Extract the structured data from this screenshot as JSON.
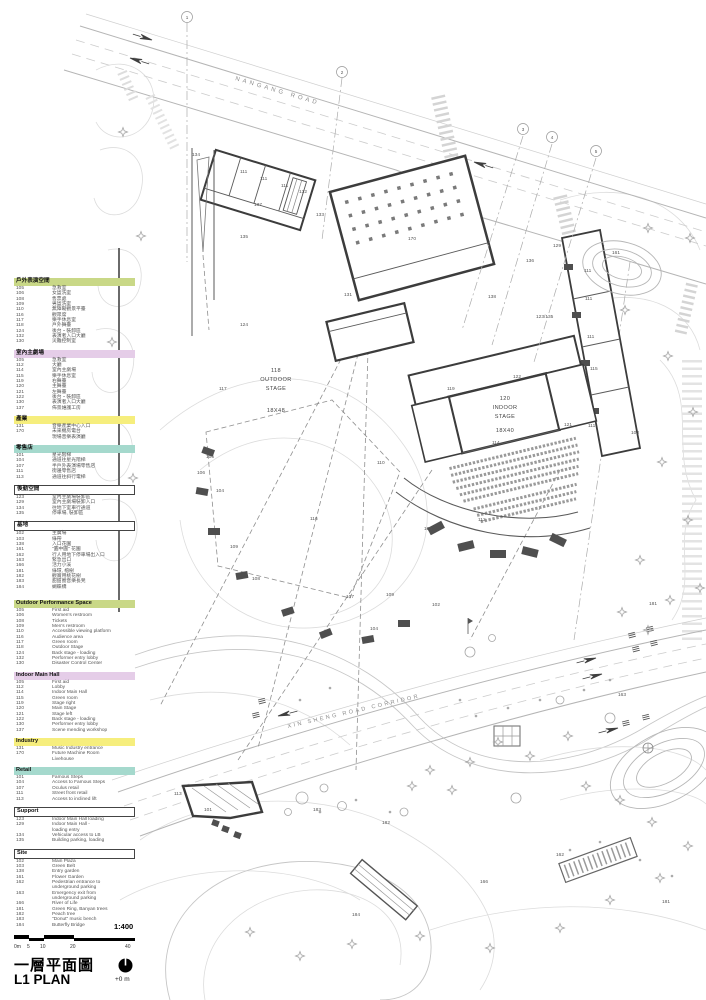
{
  "colors": {
    "outdoor": "#c9d887",
    "indoor": "#e5cde8",
    "industry": "#f6ee7d",
    "retail": "#a5d9cd",
    "plain": "#ffffff"
  },
  "roads": {
    "north_label": "NANGANG ROAD",
    "south_label": "XIN SHENG ROAD CORRIDOR"
  },
  "grid_bubbles": [
    "1",
    "2",
    "3",
    "4",
    "5"
  ],
  "stages": {
    "outdoor": {
      "code": "118",
      "line1": "OUTDOOR",
      "line2": "STAGE",
      "dim": "18X48"
    },
    "indoor": {
      "code": "120",
      "line1": "INDOOR",
      "line2": "STAGE",
      "dim": "18X40"
    }
  },
  "legend_zh": [
    {
      "header": "戶外表演空間",
      "color": "outdoor",
      "items": [
        [
          "105",
          "急救室"
        ],
        [
          "106",
          "女盥洗室"
        ],
        [
          "108",
          "售票處"
        ],
        [
          "109",
          "男盥洗室"
        ],
        [
          "110",
          "無障礙觀景平臺"
        ],
        [
          "116",
          "觀眾席"
        ],
        [
          "117",
          "樂手休息室"
        ],
        [
          "118",
          "戶外舞臺"
        ],
        [
          "124",
          "後台・裝卸區"
        ],
        [
          "132",
          "表演者入口大廳"
        ],
        [
          "130",
          "災難控制室"
        ]
      ]
    },
    {
      "header": "室內主劇場",
      "color": "indoor",
      "items": [
        [
          "105",
          "急救室"
        ],
        [
          "112",
          "大廳"
        ],
        [
          "114",
          "室內主劇場"
        ],
        [
          "115",
          "樂手休息室"
        ],
        [
          "119",
          "右舞臺"
        ],
        [
          "120",
          "主舞臺"
        ],
        [
          "121",
          "左舞臺"
        ],
        [
          "122",
          "後台・裝卸區"
        ],
        [
          "130",
          "表演者入口大廳"
        ],
        [
          "137",
          "佈景維護工房"
        ]
      ]
    },
    {
      "header": "產業",
      "color": "industry",
      "items": [
        [
          "131",
          "音樂產業中心入口"
        ],
        [
          "170",
          "未來機房電台\n現場音樂表演廳"
        ]
      ]
    },
    {
      "header": "零售店",
      "color": "retail",
      "items": [
        [
          "101",
          "星光階梯"
        ],
        [
          "104",
          "通道往星光階梯"
        ],
        [
          "107",
          "半戶外表演場零售店"
        ],
        [
          "111",
          "街邊零售店"
        ],
        [
          "113",
          "通道往斜行電梯"
        ]
      ]
    },
    {
      "header": "後勤空間",
      "color": "plain",
      "items": [
        [
          "123",
          "室內主劇場裝卸區"
        ],
        [
          "129",
          "室內主劇場裝卸入口"
        ],
        [
          "134",
          "往地下室車行通道"
        ],
        [
          "135",
          "停車場, 裝卸區"
        ]
      ]
    },
    {
      "header": "基地",
      "color": "plain",
      "items": [
        [
          "102",
          "主廣場"
        ],
        [
          "103",
          "綠帶"
        ],
        [
          "138",
          "入口花園"
        ],
        [
          "161",
          "\"圓中圓\" 花園"
        ],
        [
          "162",
          "行人用地下停車場出入口"
        ],
        [
          "163",
          "緊急出口"
        ],
        [
          "166",
          "活力小溪"
        ],
        [
          "181",
          "綠環, 榕樹"
        ],
        [
          "182",
          "觀賞用桃花樹"
        ],
        [
          "183",
          "甜甜圈音樂長凳"
        ],
        [
          "184",
          "蝴蝶橋"
        ]
      ]
    }
  ],
  "legend_en": [
    {
      "header": "Outdoor Performance Space",
      "color": "outdoor",
      "items": [
        [
          "105",
          "First aid"
        ],
        [
          "106",
          "Women's restroom"
        ],
        [
          "108",
          "Tickets"
        ],
        [
          "109",
          "Men's restroom"
        ],
        [
          "110",
          "Accessible viewing platform"
        ],
        [
          "116",
          "Audience area"
        ],
        [
          "117",
          "Green room"
        ],
        [
          "118",
          "Outdoor Stage"
        ],
        [
          "124",
          "Back stage - loading"
        ],
        [
          "132",
          "Performer entry lobby"
        ],
        [
          "130",
          "Disaster Control Center"
        ]
      ]
    },
    {
      "header": "Indoor Main Hall",
      "color": "indoor",
      "items": [
        [
          "105",
          "First aid"
        ],
        [
          "112",
          "Lobby"
        ],
        [
          "114",
          "Indoor Main Hall"
        ],
        [
          "115",
          "Green room"
        ],
        [
          "119",
          "Stage right"
        ],
        [
          "120",
          "Main Stage"
        ],
        [
          "121",
          "Stage left"
        ],
        [
          "122",
          "Back stage - loading"
        ],
        [
          "130",
          "Performer entry lobby"
        ],
        [
          "137",
          "Scene mending workshop"
        ]
      ]
    },
    {
      "header": "Industry",
      "color": "industry",
      "items": [
        [
          "131",
          "Music Industry entrance"
        ],
        [
          "170",
          "Future Machine Room\nLivehouse"
        ]
      ]
    },
    {
      "header": "Retail",
      "color": "retail",
      "items": [
        [
          "101",
          "Famous Steps"
        ],
        [
          "104",
          "Access to Famous Steps"
        ],
        [
          "107",
          "Oculus retail"
        ],
        [
          "111",
          "Street front retail"
        ],
        [
          "113",
          "Access to inclined lift"
        ]
      ]
    },
    {
      "header": "Support",
      "color": "plain",
      "items": [
        [
          "123",
          "Indoor Main Hall loading"
        ],
        [
          "129",
          "Indoor Main Hall -\nloading entry"
        ],
        [
          "134",
          "Vehicular access to LB"
        ],
        [
          "135",
          "Building parking, loading"
        ]
      ]
    },
    {
      "header": "Site",
      "color": "plain",
      "items": [
        [
          "102",
          "Main Plaza"
        ],
        [
          "103",
          "Green Belt"
        ],
        [
          "138",
          "Entry garden"
        ],
        [
          "161",
          "Flower Garden"
        ],
        [
          "162",
          "Pedestrian entrance to\nunderground parking"
        ],
        [
          "163",
          "Emergency exit from\nunderground parking"
        ],
        [
          "166",
          "River of Life"
        ],
        [
          "181",
          "Green Ring, Banyan trees"
        ],
        [
          "182",
          "Peach tree"
        ],
        [
          "183",
          "\"Donut\" music bench"
        ],
        [
          "184",
          "Butterfly Bridge"
        ]
      ]
    }
  ],
  "plan_labels": [
    {
      "t": "134",
      "x": 192,
      "y": 156
    },
    {
      "t": "111",
      "x": 240,
      "y": 173
    },
    {
      "t": "111",
      "x": 260,
      "y": 180
    },
    {
      "t": "111",
      "x": 281,
      "y": 187
    },
    {
      "t": "132",
      "x": 299,
      "y": 193
    },
    {
      "t": "137",
      "x": 254,
      "y": 206
    },
    {
      "t": "133",
      "x": 316,
      "y": 216
    },
    {
      "t": "135",
      "x": 240,
      "y": 238
    },
    {
      "t": "170",
      "x": 408,
      "y": 240
    },
    {
      "t": "131",
      "x": 344,
      "y": 296
    },
    {
      "t": "129",
      "x": 553,
      "y": 247
    },
    {
      "t": "136",
      "x": 526,
      "y": 262
    },
    {
      "t": "138",
      "x": 488,
      "y": 298
    },
    {
      "t": "123/135",
      "x": 536,
      "y": 318
    },
    {
      "t": "111",
      "x": 584,
      "y": 272
    },
    {
      "t": "111",
      "x": 585,
      "y": 300
    },
    {
      "t": "111",
      "x": 587,
      "y": 338
    },
    {
      "t": "115",
      "x": 590,
      "y": 370
    },
    {
      "t": "124",
      "x": 240,
      "y": 326
    },
    {
      "t": "117",
      "x": 219,
      "y": 390
    },
    {
      "t": "122",
      "x": 513,
      "y": 378
    },
    {
      "t": "119",
      "x": 447,
      "y": 390
    },
    {
      "t": "121",
      "x": 564,
      "y": 426
    },
    {
      "t": "111",
      "x": 588,
      "y": 427
    },
    {
      "t": "114",
      "x": 492,
      "y": 444
    },
    {
      "t": "112",
      "x": 478,
      "y": 521
    },
    {
      "t": "105",
      "x": 424,
      "y": 530
    },
    {
      "t": "110",
      "x": 377,
      "y": 464
    },
    {
      "t": "116",
      "x": 310,
      "y": 520
    },
    {
      "t": "105",
      "x": 206,
      "y": 458
    },
    {
      "t": "106",
      "x": 197,
      "y": 474
    },
    {
      "t": "104",
      "x": 216,
      "y": 492
    },
    {
      "t": "109",
      "x": 230,
      "y": 548
    },
    {
      "t": "108",
      "x": 252,
      "y": 580
    },
    {
      "t": "107",
      "x": 346,
      "y": 598
    },
    {
      "t": "109",
      "x": 386,
      "y": 596
    },
    {
      "t": "104",
      "x": 370,
      "y": 630
    },
    {
      "t": "102",
      "x": 432,
      "y": 606
    },
    {
      "t": "103",
      "x": 631,
      "y": 434
    },
    {
      "t": "161",
      "x": 612,
      "y": 254
    },
    {
      "t": "113",
      "x": 174,
      "y": 795
    },
    {
      "t": "101",
      "x": 204,
      "y": 811
    },
    {
      "t": "183",
      "x": 313,
      "y": 811
    },
    {
      "t": "182",
      "x": 382,
      "y": 824
    },
    {
      "t": "166",
      "x": 480,
      "y": 883
    },
    {
      "t": "181",
      "x": 649,
      "y": 605
    },
    {
      "t": "181",
      "x": 662,
      "y": 903
    },
    {
      "t": "162",
      "x": 556,
      "y": 856
    },
    {
      "t": "163",
      "x": 618,
      "y": 696
    },
    {
      "t": "184",
      "x": 352,
      "y": 916
    }
  ],
  "title_block": {
    "scale_label": "1:400",
    "ticks": [
      "0m",
      "5",
      "10",
      "20",
      "40"
    ],
    "title_zh": "一層平面圖",
    "title_en": "L1 PLAN",
    "elevation": "+0 m"
  }
}
